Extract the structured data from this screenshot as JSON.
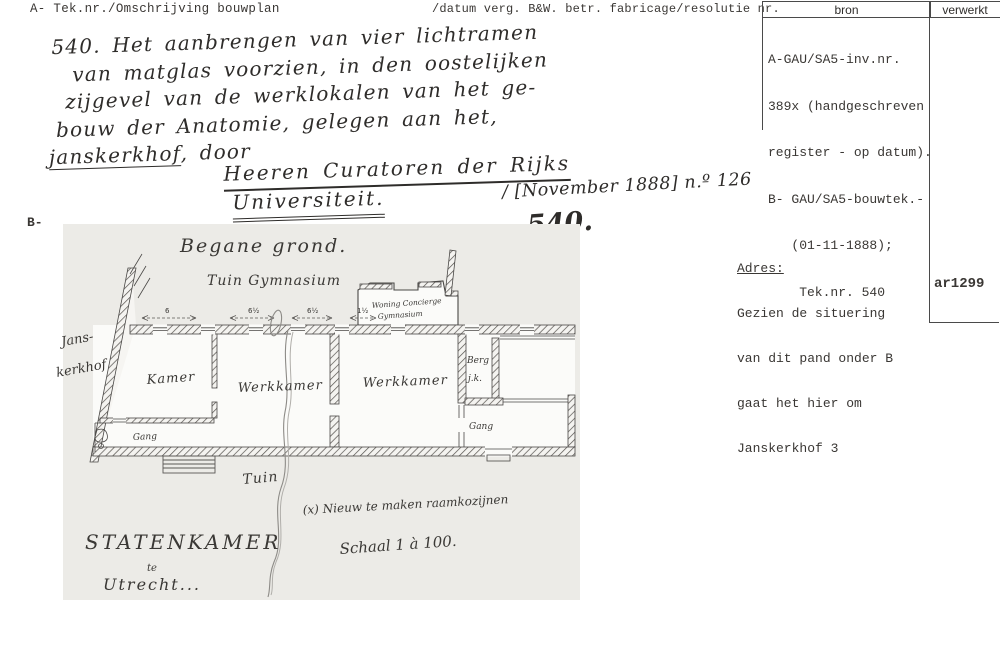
{
  "header": {
    "col_left": "A- Tek.nr./Omschrijving bouwplan",
    "col_mid": "/datum verg. B&W. betr. fabricage/resolutie nr.",
    "bron_label": "bron",
    "verwerkt_label": "verwerkt"
  },
  "bron_panel": {
    "line1": "A-GAU/SA5-inv.nr.",
    "line2": "389x (handgeschreven",
    "line3": "register - op datum).",
    "line4": "B- GAU/SA5-bouwtek.-",
    "line5": "   (01-11-1888);",
    "line6": "    Tek.nr. 540"
  },
  "handwritten": {
    "line1": "540. Het aanbrengen van vier lichtramen",
    "line2": "van matglas voorzien, in den oostelijken",
    "line3": "zijgevel van de werklokalen van het ge-",
    "line4": "bouw der Anatomie, gelegen aan het,",
    "line5_underlined": "janskerkhof",
    "line5_rest": ", door",
    "signature1": "Heeren Curatoren der Rijks",
    "signature2": "Universiteit.",
    "date_note": "/ [November 1888] n.º 126",
    "big_number": "540."
  },
  "margin_label_b": "B-",
  "adres": {
    "title": "Adres:",
    "line1": "Gezien de situering",
    "line2": "van dit pand onder B",
    "line3": "gaat het hier om",
    "line4": "Janskerkhof 3"
  },
  "ar_code": "ar1299",
  "plan": {
    "title": "Begane grond.",
    "garden_label": "Tuin Gymnasium",
    "street": {
      "line1": "Jans-",
      "line2": "kerkhof"
    },
    "rooms": {
      "kamer": "Kamer",
      "werkkamer_left": "Werkkamer",
      "werkkamer_right": "Werkkamer",
      "berg": "Berg",
      "jk": "j.k.",
      "gang_left": "Gang",
      "gang_right": "Gang"
    },
    "annex": {
      "line1": "Woning Concierge",
      "line2": "Gymnasium"
    },
    "tuin_label": "Tuin",
    "note": "(x) Nieuw te maken raamkozijnen",
    "scale": "Schaal 1 à 100.",
    "cartouche": {
      "line1": "Statenkamer",
      "line2": "te",
      "line3": "Utrecht..."
    },
    "dimensions": {
      "d1": "6",
      "d2": "6½",
      "d3": "6½",
      "d4": "1½"
    }
  },
  "colors": {
    "paper": "#ffffff",
    "scan_gray": "#ecebe7",
    "ink": "#2e2c2a",
    "type_ink": "#3a3734"
  }
}
